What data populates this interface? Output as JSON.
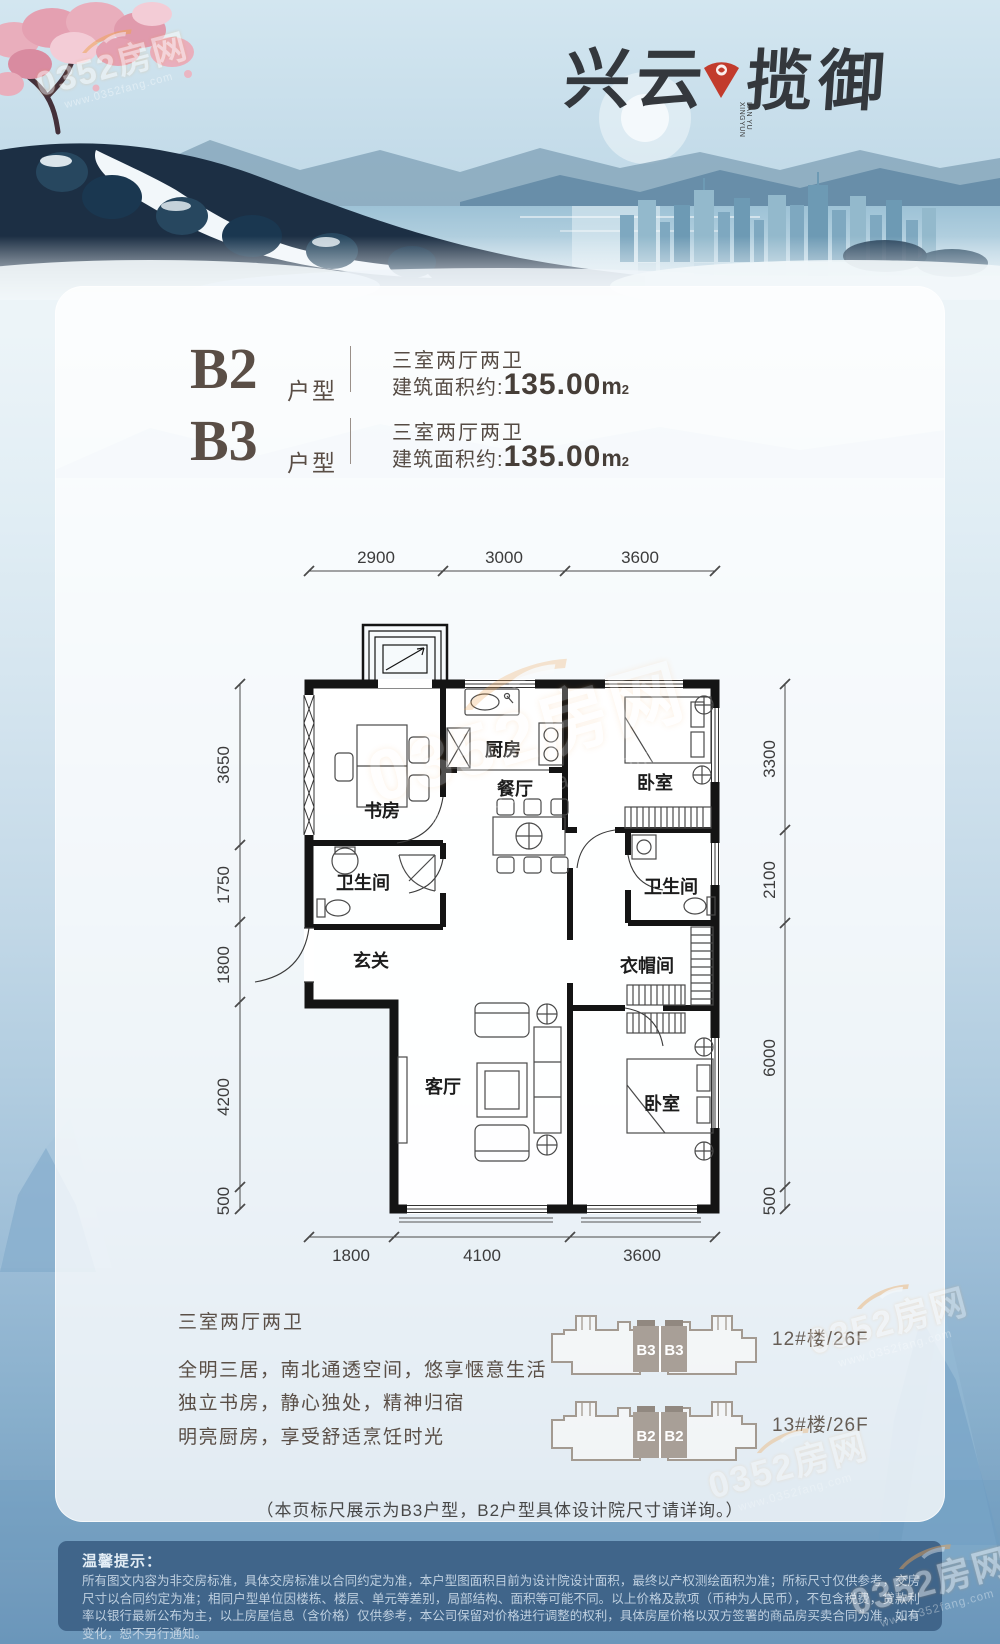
{
  "header": {
    "logo_left": "兴云",
    "logo_right": "揽御",
    "seal_line1": "LAN YU",
    "seal_line2": "XINGYUN"
  },
  "watermark": {
    "text": "0352房网",
    "url": "www.0352fang.com"
  },
  "units": [
    {
      "code": "B2",
      "code_suffix": "户型",
      "layout": "三室两厅两卫",
      "area_label": "建筑面积约:",
      "area_value": "135.00",
      "area_unit": "m",
      "area_exp": "2"
    },
    {
      "code": "B3",
      "code_suffix": "户型",
      "layout": "三室两厅两卫",
      "area_label": "建筑面积约:",
      "area_value": "135.00",
      "area_unit": "m",
      "area_exp": "2"
    }
  ],
  "plan": {
    "dims_top": [
      "2900",
      "3000",
      "3600"
    ],
    "dims_left": [
      "3650",
      "1750",
      "1800",
      "4200",
      "500"
    ],
    "dims_right": [
      "3300",
      "2100",
      "6000",
      "500"
    ],
    "dims_bottom": [
      "1800",
      "4100",
      "3600"
    ],
    "rooms": {
      "study": "书房",
      "kitchen": "厨房",
      "dining": "餐厅",
      "bedroom_top": "卧室",
      "bath_left": "卫生间",
      "bath_right": "卫生间",
      "entry": "玄关",
      "closet": "衣帽间",
      "living": "客厅",
      "bedroom_bottom": "卧室"
    }
  },
  "description": {
    "title": "三室两厅两卫",
    "lines": [
      "全明三居，南北通透空间，悠享惬意生活",
      "独立书房，静心独处，精神归宿",
      "明亮厨房，享受舒适烹饪时光"
    ]
  },
  "buildings": [
    {
      "left_unit": "B3",
      "right_unit": "B3",
      "label": "12#楼/26F"
    },
    {
      "left_unit": "B2",
      "right_unit": "B2",
      "label": "13#楼/26F"
    }
  ],
  "note": "（本页标尺展示为B3户型，B2户型具体设计院尺寸请详询。）",
  "disclaimer": {
    "title": "温馨提示：",
    "body": "所有图文内容为非交房标准，具体交房标准以合同约定为准，本户型图面积目前为设计院设计面积，最终以产权测绘面积为准；所标尺寸仅供参考，交房尺寸以合同约定为准；相同户型单位因楼栋、楼层、单元等差别，局部结构、面积等可能不同。以上价格及款项（币种为人民币），不包含税费，贷款利率以银行最新公布为主，以上房屋信息（含价格）仅供参考，本公司保留对价格进行调整的权利，具体房屋价格以双方签署的商品房买卖合同为准，如有变化，恕不另行通知。"
  },
  "colors": {
    "seal_red": "#c23b2c",
    "band_blue": "#40658a",
    "unit_gray": "#a89f97"
  }
}
